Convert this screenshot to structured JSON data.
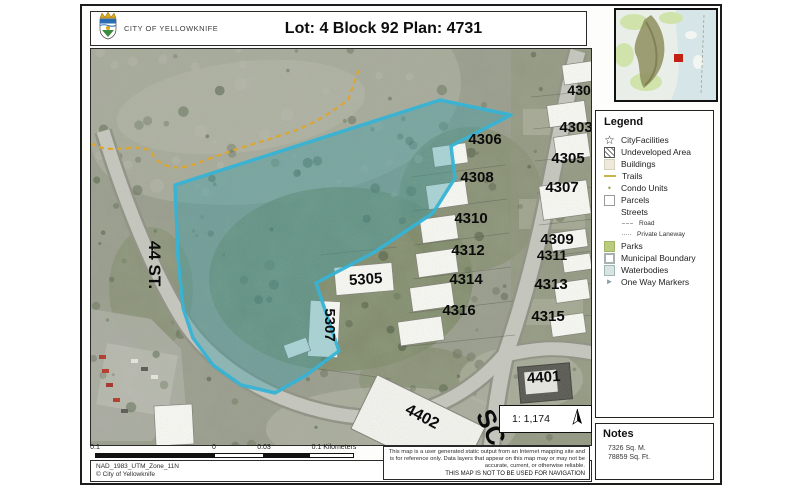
{
  "header": {
    "agency": "CITY OF YELLOWKNIFE",
    "title": "Lot: 4 Block 92 Plan: 4731"
  },
  "map": {
    "labels": [
      {
        "text": "4301",
        "x": 492,
        "y": 46,
        "rot": 0,
        "size": 14
      },
      {
        "text": "4303",
        "x": 485,
        "y": 83,
        "rot": 0,
        "size": 15
      },
      {
        "text": "4305",
        "x": 477,
        "y": 114,
        "rot": 0,
        "size": 15
      },
      {
        "text": "4307",
        "x": 471,
        "y": 143,
        "rot": 0,
        "size": 15
      },
      {
        "text": "4309",
        "x": 466,
        "y": 195,
        "rot": 0,
        "size": 15
      },
      {
        "text": "4311",
        "x": 461,
        "y": 211,
        "rot": 0,
        "size": 14
      },
      {
        "text": "4313",
        "x": 460,
        "y": 240,
        "rot": 0,
        "size": 15
      },
      {
        "text": "4315",
        "x": 457,
        "y": 272,
        "rot": 0,
        "size": 15
      },
      {
        "text": "4306",
        "x": 394,
        "y": 95,
        "rot": 0,
        "size": 15
      },
      {
        "text": "4308",
        "x": 386,
        "y": 133,
        "rot": 0,
        "size": 15
      },
      {
        "text": "4310",
        "x": 380,
        "y": 174,
        "rot": 0,
        "size": 15
      },
      {
        "text": "4312",
        "x": 377,
        "y": 206,
        "rot": 0,
        "size": 15
      },
      {
        "text": "4314",
        "x": 375,
        "y": 235,
        "rot": 0,
        "size": 15
      },
      {
        "text": "4316",
        "x": 368,
        "y": 266,
        "rot": 0,
        "size": 15
      },
      {
        "text": "5305",
        "x": 275,
        "y": 235,
        "rot": -4,
        "size": 15
      },
      {
        "text": "5307",
        "x": 234,
        "y": 276,
        "rot": 90,
        "size": 15
      },
      {
        "text": "4402",
        "x": 329,
        "y": 372,
        "rot": 28,
        "size": 16
      },
      {
        "text": "4401",
        "x": 453,
        "y": 333,
        "rot": -4,
        "size": 15
      },
      {
        "text": "44 ST.",
        "x": 58,
        "y": 216,
        "rot": 90,
        "size": 17
      },
      {
        "text": "SC",
        "x": 392,
        "y": 382,
        "rot": 65,
        "size": 26
      }
    ],
    "highlight_outline": "#27b3da",
    "highlight_fill": "#2e9aa8",
    "trail_color": "#e2a41f"
  },
  "inset": {
    "marker_color": "#c42014"
  },
  "legend": {
    "title": "Legend",
    "items": [
      {
        "icon": "star",
        "label": "CityFacilities"
      },
      {
        "icon": "hatch",
        "label": "Undeveloped Area"
      },
      {
        "icon": "building",
        "label": "Buildings"
      },
      {
        "icon": "dash",
        "label": "Trails"
      },
      {
        "icon": "dot",
        "label": "Condo Units"
      },
      {
        "icon": "parcel",
        "label": "Parcels"
      },
      {
        "icon": "none",
        "label": "Streets"
      },
      {
        "icon": "roaddash",
        "label": "Road",
        "indent": true,
        "small": true
      },
      {
        "icon": "lanedash",
        "label": "Private Laneway",
        "indent": true,
        "small": true
      },
      {
        "icon": "parks",
        "label": "Parks"
      },
      {
        "icon": "muni",
        "label": "Municipal Boundary"
      },
      {
        "icon": "water",
        "label": "Waterbodies"
      },
      {
        "icon": "oneway",
        "label": "One Way Markers"
      }
    ]
  },
  "notes": {
    "title": "Notes",
    "lines": [
      "7326 Sq. M.",
      "78859 Sq. Ft."
    ]
  },
  "scale_ratio": "1: 1,174",
  "scalebar": {
    "labels": [
      "0.1",
      "0",
      "0.03",
      "0.1 Kilometers"
    ]
  },
  "projection": {
    "lines": [
      "NAD_1983_UTM_Zone_11N",
      "© City of Yellowknife"
    ]
  },
  "disclaimer": {
    "body": "This map is a user generated static output from an Internet mapping site and is for reference only. Data layers that appear on this map may or may not be accurate, current, or otherwise reliable.",
    "warning": "THIS MAP IS NOT TO BE USED FOR NAVIGATION"
  }
}
